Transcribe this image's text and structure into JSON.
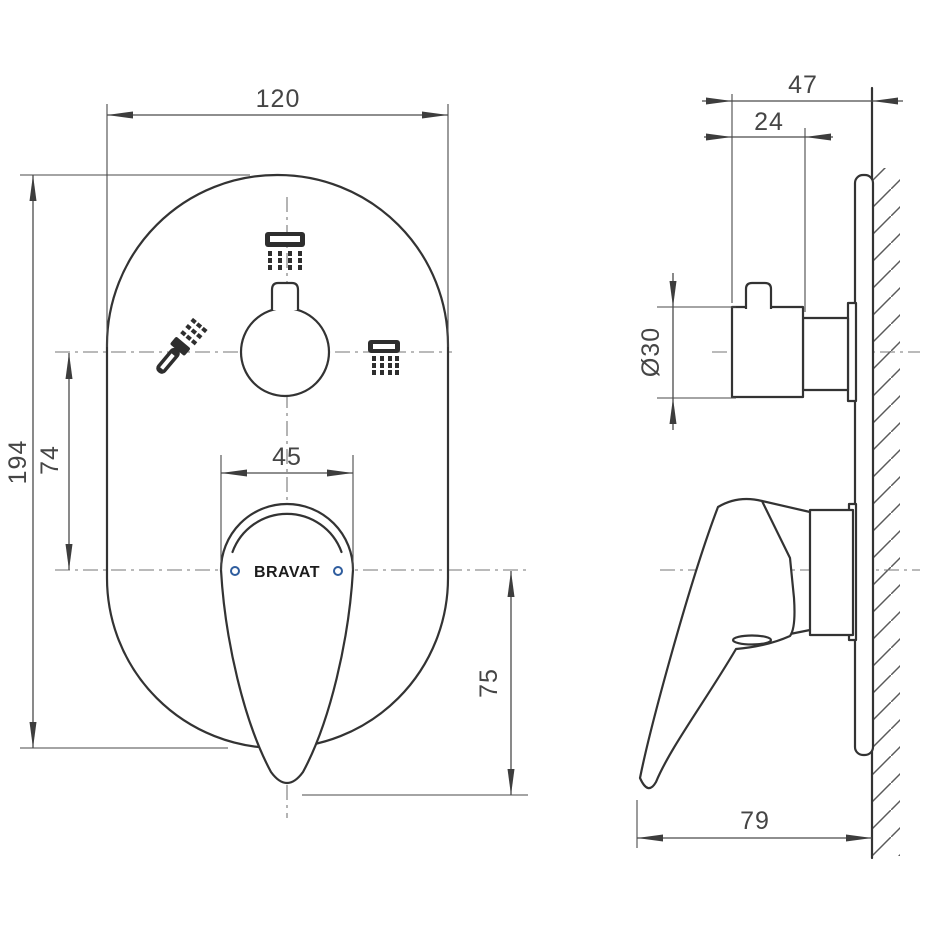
{
  "drawing": {
    "product": "concealed shower mixer installation drawing",
    "brand_logo": "BRAVAT",
    "front_view": {
      "dimensions": {
        "plate_width": "120",
        "plate_height": "194",
        "knob_to_handle_center": "74",
        "handle_width": "45",
        "handle_drop": "75"
      },
      "icons": [
        "rain-shower",
        "hand-shower",
        "overhead-shower"
      ]
    },
    "side_view": {
      "dimensions": {
        "total_depth": "47",
        "knob_depth": "24",
        "knob_diameter": "Ø30",
        "handle_reach": "79"
      }
    },
    "colors": {
      "object_line": "#333333",
      "dimension_line": "#4a4a4a",
      "centerline": "#767676",
      "accent_blue": "#2f5d9e",
      "background": "#ffffff"
    }
  }
}
